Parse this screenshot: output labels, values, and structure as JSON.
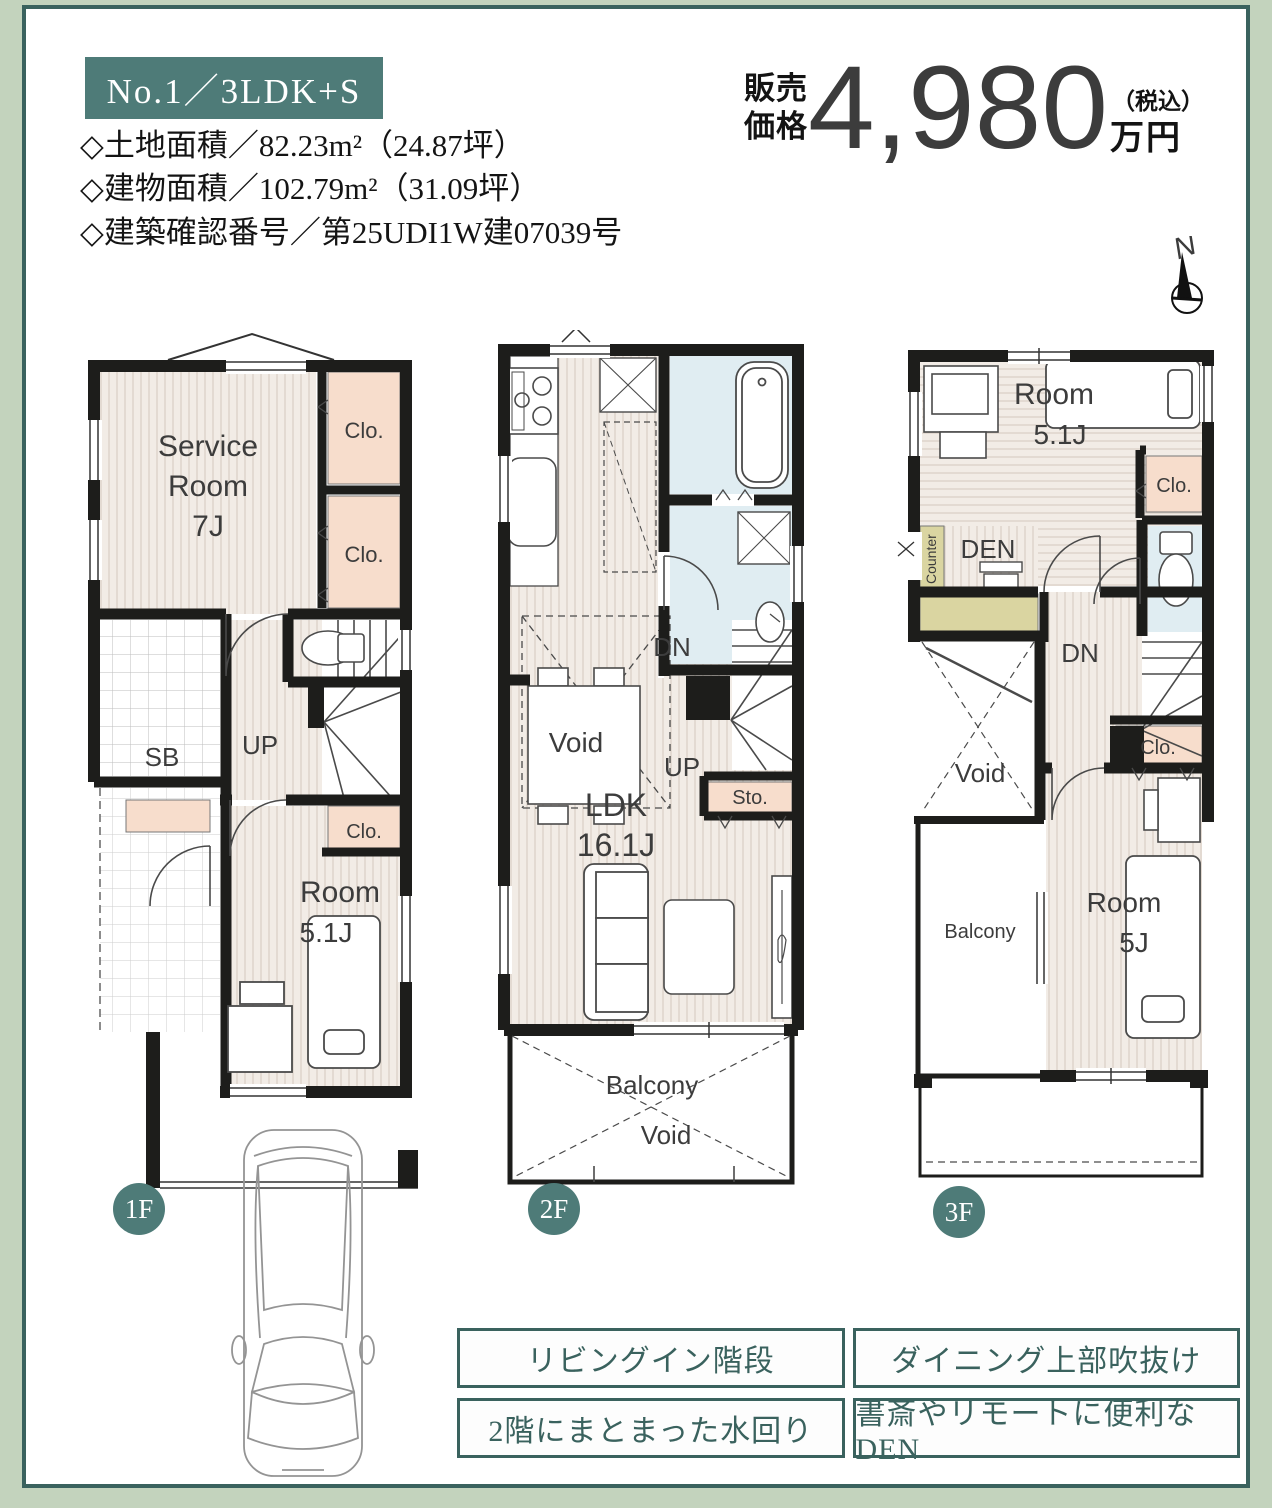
{
  "header": {
    "badge": "No.1／3LDK+S",
    "specs": [
      "◇土地面積／82.23m²（24.87坪）",
      "◇建物面積／102.79m²（31.09坪）",
      "◇建築確認番号／第25UDI1W建07039号"
    ],
    "price": {
      "label_line1": "販売",
      "label_line2": "価格",
      "amount": "4,980",
      "tax_note": "（税込）",
      "unit": "万円"
    },
    "compass_label": "N"
  },
  "floors": {
    "f1": {
      "badge": "1F",
      "labels": {
        "service_1": "Service",
        "service_2": "Room",
        "service_3": "7J",
        "clo_1": "Clo.",
        "clo_2": "Clo.",
        "clo_3": "Clo.",
        "sb": "SB",
        "up": "UP",
        "room_1": "Room",
        "room_2": "5.1J"
      }
    },
    "f2": {
      "badge": "2F",
      "labels": {
        "dn": "DN",
        "up": "UP",
        "void_dining": "Void",
        "ldk_1": "LDK",
        "ldk_2": "16.1J",
        "sto": "Sto.",
        "balcony": "Balcony",
        "void_balcony": "Void"
      }
    },
    "f3": {
      "badge": "3F",
      "labels": {
        "room_top_1": "Room",
        "room_top_2": "5.1J",
        "clo_1": "Clo.",
        "clo_2": "Clo.",
        "counter": "Counter",
        "den": "DEN",
        "dn": "DN",
        "void": "Void",
        "balcony": "Balcony",
        "room_bottom_1": "Room",
        "room_bottom_2": "5J"
      }
    }
  },
  "features": [
    {
      "label": "リビングイン階段"
    },
    {
      "label": "ダイニング上部吹抜け"
    },
    {
      "label": "2階にまとまった水回り"
    },
    {
      "label": "書斎やリモートに便利なDEN"
    }
  ],
  "colors": {
    "frame": "#c3d3bd",
    "frame_border": "#3a625e",
    "accent_teal": "#4e7b78",
    "price_top": "#9b1e23",
    "price_bottom": "#e5793b",
    "closet_pink": "#f7ddcc",
    "wet_blue": "#e0edf2",
    "counter_olive": "#dad5a1"
  }
}
